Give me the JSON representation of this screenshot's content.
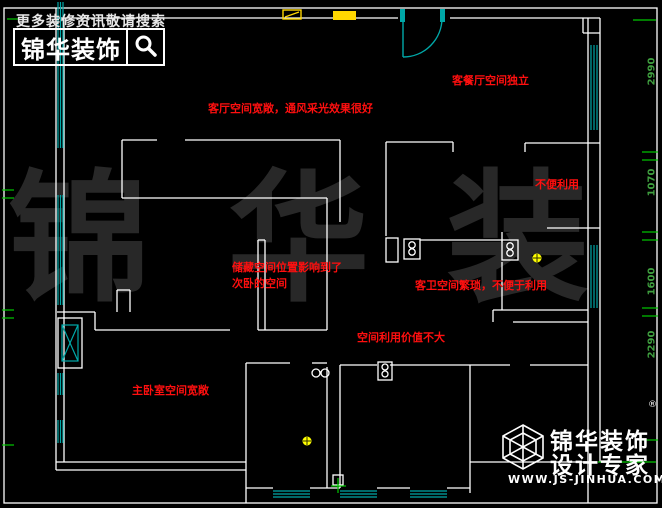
{
  "header": {
    "tagline": "更多装修资讯敬请搜索",
    "logo_text": "锦华装饰"
  },
  "watermark": {
    "text": "锦 华 装 饰"
  },
  "annotations": [
    {
      "text": "客厅空间宽敞，通风采光效果很好"
    },
    {
      "text": "客餐厅空间独立"
    },
    {
      "text": "不便利用"
    },
    {
      "text": "储藏空间位置影响到了\n次卧的空间"
    },
    {
      "text": "客卫空间繁琐，不便于利用"
    },
    {
      "text": "空间利用价值不大"
    },
    {
      "text": "主卧室空间宽敞"
    }
  ],
  "dimensions": {
    "right": [
      "2990",
      "1070",
      "1600",
      "2290"
    ]
  },
  "footer": {
    "brand_line1": "锦华装饰",
    "brand_line2": "设计专家",
    "website": "WWW.JS-JINHUA.COM",
    "registered_mark": "®"
  },
  "colors": {
    "wall": "#ffffff",
    "window": "#00a8a8",
    "dimension_green": "#00c800",
    "annotation_red": "#ff0f0f",
    "symbol_yellow": "#ffd700",
    "watermark_gray": "#282828"
  }
}
